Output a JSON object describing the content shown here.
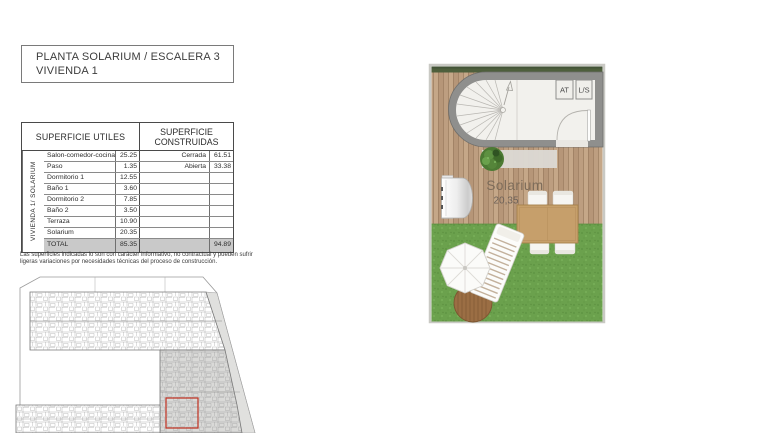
{
  "title": {
    "line1": "PLANTA SOLARIUM / ESCALERA 3",
    "line2": "VIVIENDA 1"
  },
  "areas_table": {
    "header_utiles": "SUPERFICIE UTILES",
    "header_construidas": "SUPERFICIE CONSTRUIDAS",
    "row_group_label": "VIVIENDA 1/ SOLARIUM",
    "rows": [
      {
        "name": "Salon-comedor-cocina",
        "value": "25.25",
        "c_label": "Cerrada",
        "c_value": "61.51"
      },
      {
        "name": "Paso",
        "value": "1.35",
        "c_label": "Abierta",
        "c_value": "33.38"
      },
      {
        "name": "Dormitorio 1",
        "value": "12.55",
        "c_label": "",
        "c_value": ""
      },
      {
        "name": "Baño 1",
        "value": "3.60",
        "c_label": "",
        "c_value": ""
      },
      {
        "name": "Dormitorio 2",
        "value": "7.85",
        "c_label": "",
        "c_value": ""
      },
      {
        "name": "Baño 2",
        "value": "3.50",
        "c_label": "",
        "c_value": ""
      },
      {
        "name": "Terraza",
        "value": "10.90",
        "c_label": "",
        "c_value": ""
      },
      {
        "name": "Solarium",
        "value": "20.35",
        "c_label": "",
        "c_value": ""
      }
    ],
    "total_label": "TOTAL",
    "total_utiles": "85.35",
    "total_construidas": "94.89"
  },
  "footnote": "Las superficies indicadas lo son con carácter informativo, no contractual y pueden sufrir ligeras variaciones por necesidades técnicas del proceso de construcción.",
  "floor_plan": {
    "room_label": "Solarium",
    "room_area": "20,35",
    "closets": [
      "AT",
      "L/S"
    ]
  },
  "colors": {
    "deck_wood": "#bb9c7e",
    "grass": "#6ba14d",
    "wall_gray": "#8f8f8d",
    "hedge_green": "#4e5f3c",
    "room_white": "#f2f1ed",
    "total_row_gray": "#c9c9c9",
    "highlight_red": "#c0392b"
  }
}
